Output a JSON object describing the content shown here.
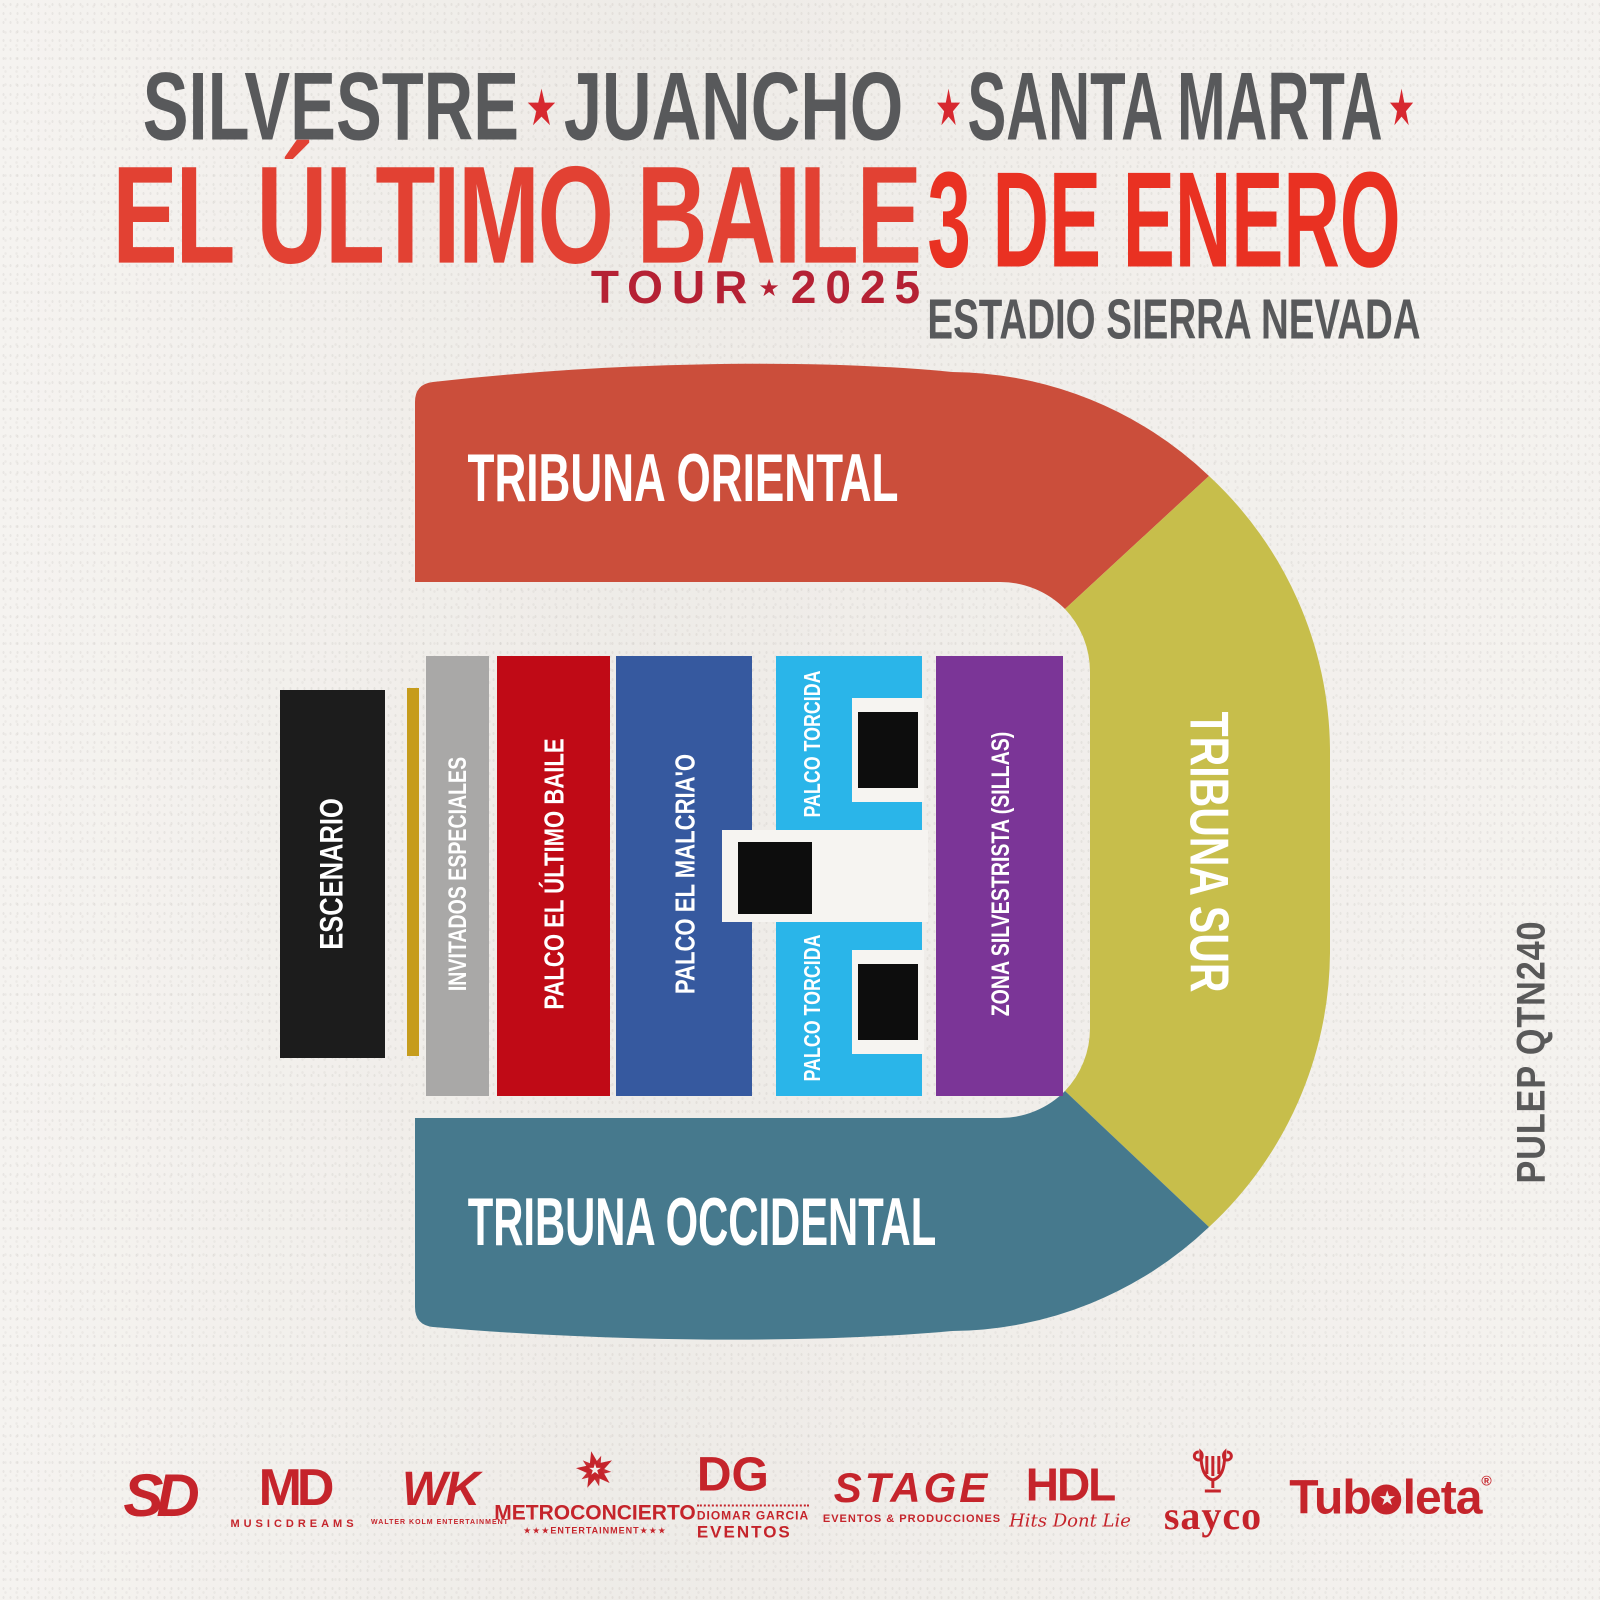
{
  "page": {
    "bg": "#f2efeb"
  },
  "header": {
    "left": {
      "artist1": "SILVESTRE",
      "sep": "★",
      "artist2": "JUANCHO",
      "title": "EL ÚLTIMO BAILE",
      "tour_label": "TOUR",
      "tour_sep": "★",
      "tour_year": "2025",
      "artist_color": "#58595b",
      "title_color": "#e2413358",
      "title_color_solid": "#e24133",
      "tour_color": "#b52134",
      "star_color": "#d7282f"
    },
    "right": {
      "star_left": "★",
      "city": "SANTA MARTA",
      "star_right": "★",
      "date": "3 DE ENERO",
      "venue": "ESTADIO SIERRA NEVADA",
      "city_color": "#58595b",
      "date_color": "#e93122",
      "venue_color": "#58595b",
      "star_color": "#d7282f"
    }
  },
  "map": {
    "tribunes": [
      {
        "label": "TRIBUNA ORIENTAL",
        "color": "#cb4e3b"
      },
      {
        "label": "TRIBUNA SUR",
        "color": "#c7be4b"
      },
      {
        "label": "TRIBUNA OCCIDENTAL",
        "color": "#46798d"
      }
    ],
    "zones": [
      {
        "label": "ESCENARIO",
        "color": "#1c1c1c"
      },
      {
        "label": "INVITADOS ESPECIALES",
        "color": "#a9a8a7"
      },
      {
        "label": "PALCO EL ÚLTIMO BAILE",
        "color": "#c00a16"
      },
      {
        "label": "PALCO EL MALCRIA'O",
        "color": "#36599f"
      },
      {
        "label": "PALCO TORCIDA",
        "color": "#2ab5e9"
      },
      {
        "label": "PALCO TORCIDA",
        "color": "#2ab5e9"
      },
      {
        "label": "ZONA SILVESTRISTA (SILLAS)",
        "color": "#7b3597"
      }
    ],
    "barrier_color": "#c69c1c",
    "tower_color": "#0d0d0d",
    "notch_color": "#f6f4f1",
    "label_color": "#ffffff"
  },
  "pulep": {
    "code": "PULEP QTN240",
    "color": "#595959"
  },
  "sponsors": {
    "color": "#c5242b",
    "items": [
      {
        "main": "SD"
      },
      {
        "main": "MD",
        "sub": "MUSICDREAMS"
      },
      {
        "main": "WK",
        "sub": "WALTER KOLM ENTERTAINMENT"
      },
      {
        "icon": "★",
        "icon_inner": "★",
        "main": "METROCONCIERTO",
        "sub": "★★★ENTERTAINMENT★★★"
      },
      {
        "main": "DG",
        "sub": "DIOMAR GARCIA",
        "sub2": "EVENTOS"
      },
      {
        "main": "STAGE",
        "sub": "EVENTOS & PRODUCCIONES"
      },
      {
        "main": "HDL",
        "sub": "Hits Dont Lie"
      },
      {
        "main": "sayco"
      },
      {
        "part1": "Tub",
        "star": "★",
        "part2": "leta",
        "reg": "®"
      }
    ]
  }
}
